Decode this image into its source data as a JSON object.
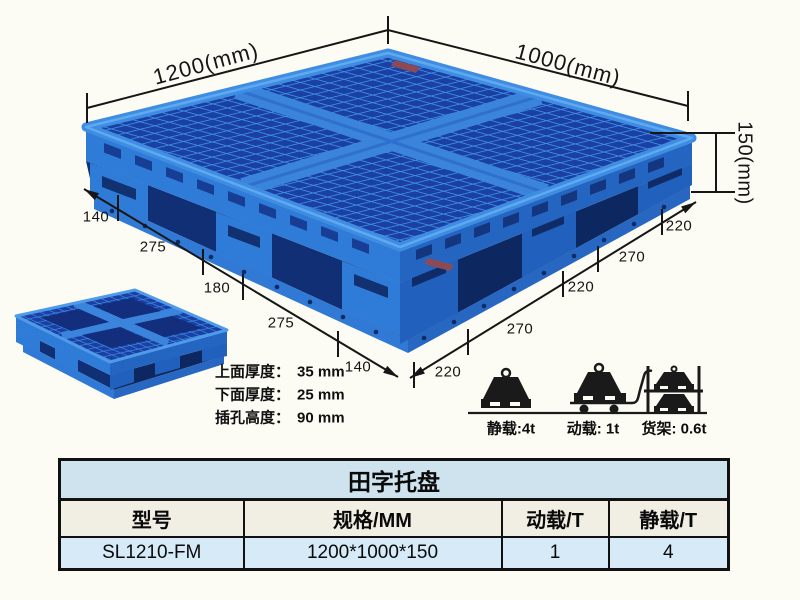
{
  "page": {
    "background": "#fcfcf5"
  },
  "diagram": {
    "top_width_label": "1200(mm)",
    "top_depth_label": "1000(mm)",
    "height_label": "150(mm)",
    "bottom_left_segments": [
      "140",
      "275",
      "180",
      "275",
      "140"
    ],
    "bottom_right_segments": [
      "220",
      "270",
      "220",
      "270",
      "220"
    ],
    "thickness_notes": [
      {
        "label": "上面厚度：",
        "value": "35 mm"
      },
      {
        "label": "下面厚度：",
        "value": "25 mm"
      },
      {
        "label": "插孔高度：",
        "value": "90 mm"
      }
    ]
  },
  "capacity_icons": [
    {
      "name": "static-load",
      "label": "静载:4t"
    },
    {
      "name": "dynamic-load",
      "label": "动载: 1t"
    },
    {
      "name": "rack-load",
      "label": "货架: 0.6t"
    }
  ],
  "spec_table": {
    "title": "田字托盘",
    "headers": [
      "型号",
      "规格/MM",
      "动载/T",
      "静载/T"
    ],
    "rows": [
      [
        "SL1210-FM",
        "1200*1000*150",
        "1",
        "4"
      ]
    ]
  },
  "colors": {
    "pallet_blue": "#2e7cd8",
    "pallet_blue_dark": "#2365c0",
    "pallet_hole_navy": "#1a40a4",
    "rib_light": "#3f8de2",
    "dimension_line": "#161616",
    "table_title_bg": "#cfe3ef",
    "table_header_bg": "#f1eee4",
    "table_row_bg": "#d6eaf7"
  }
}
